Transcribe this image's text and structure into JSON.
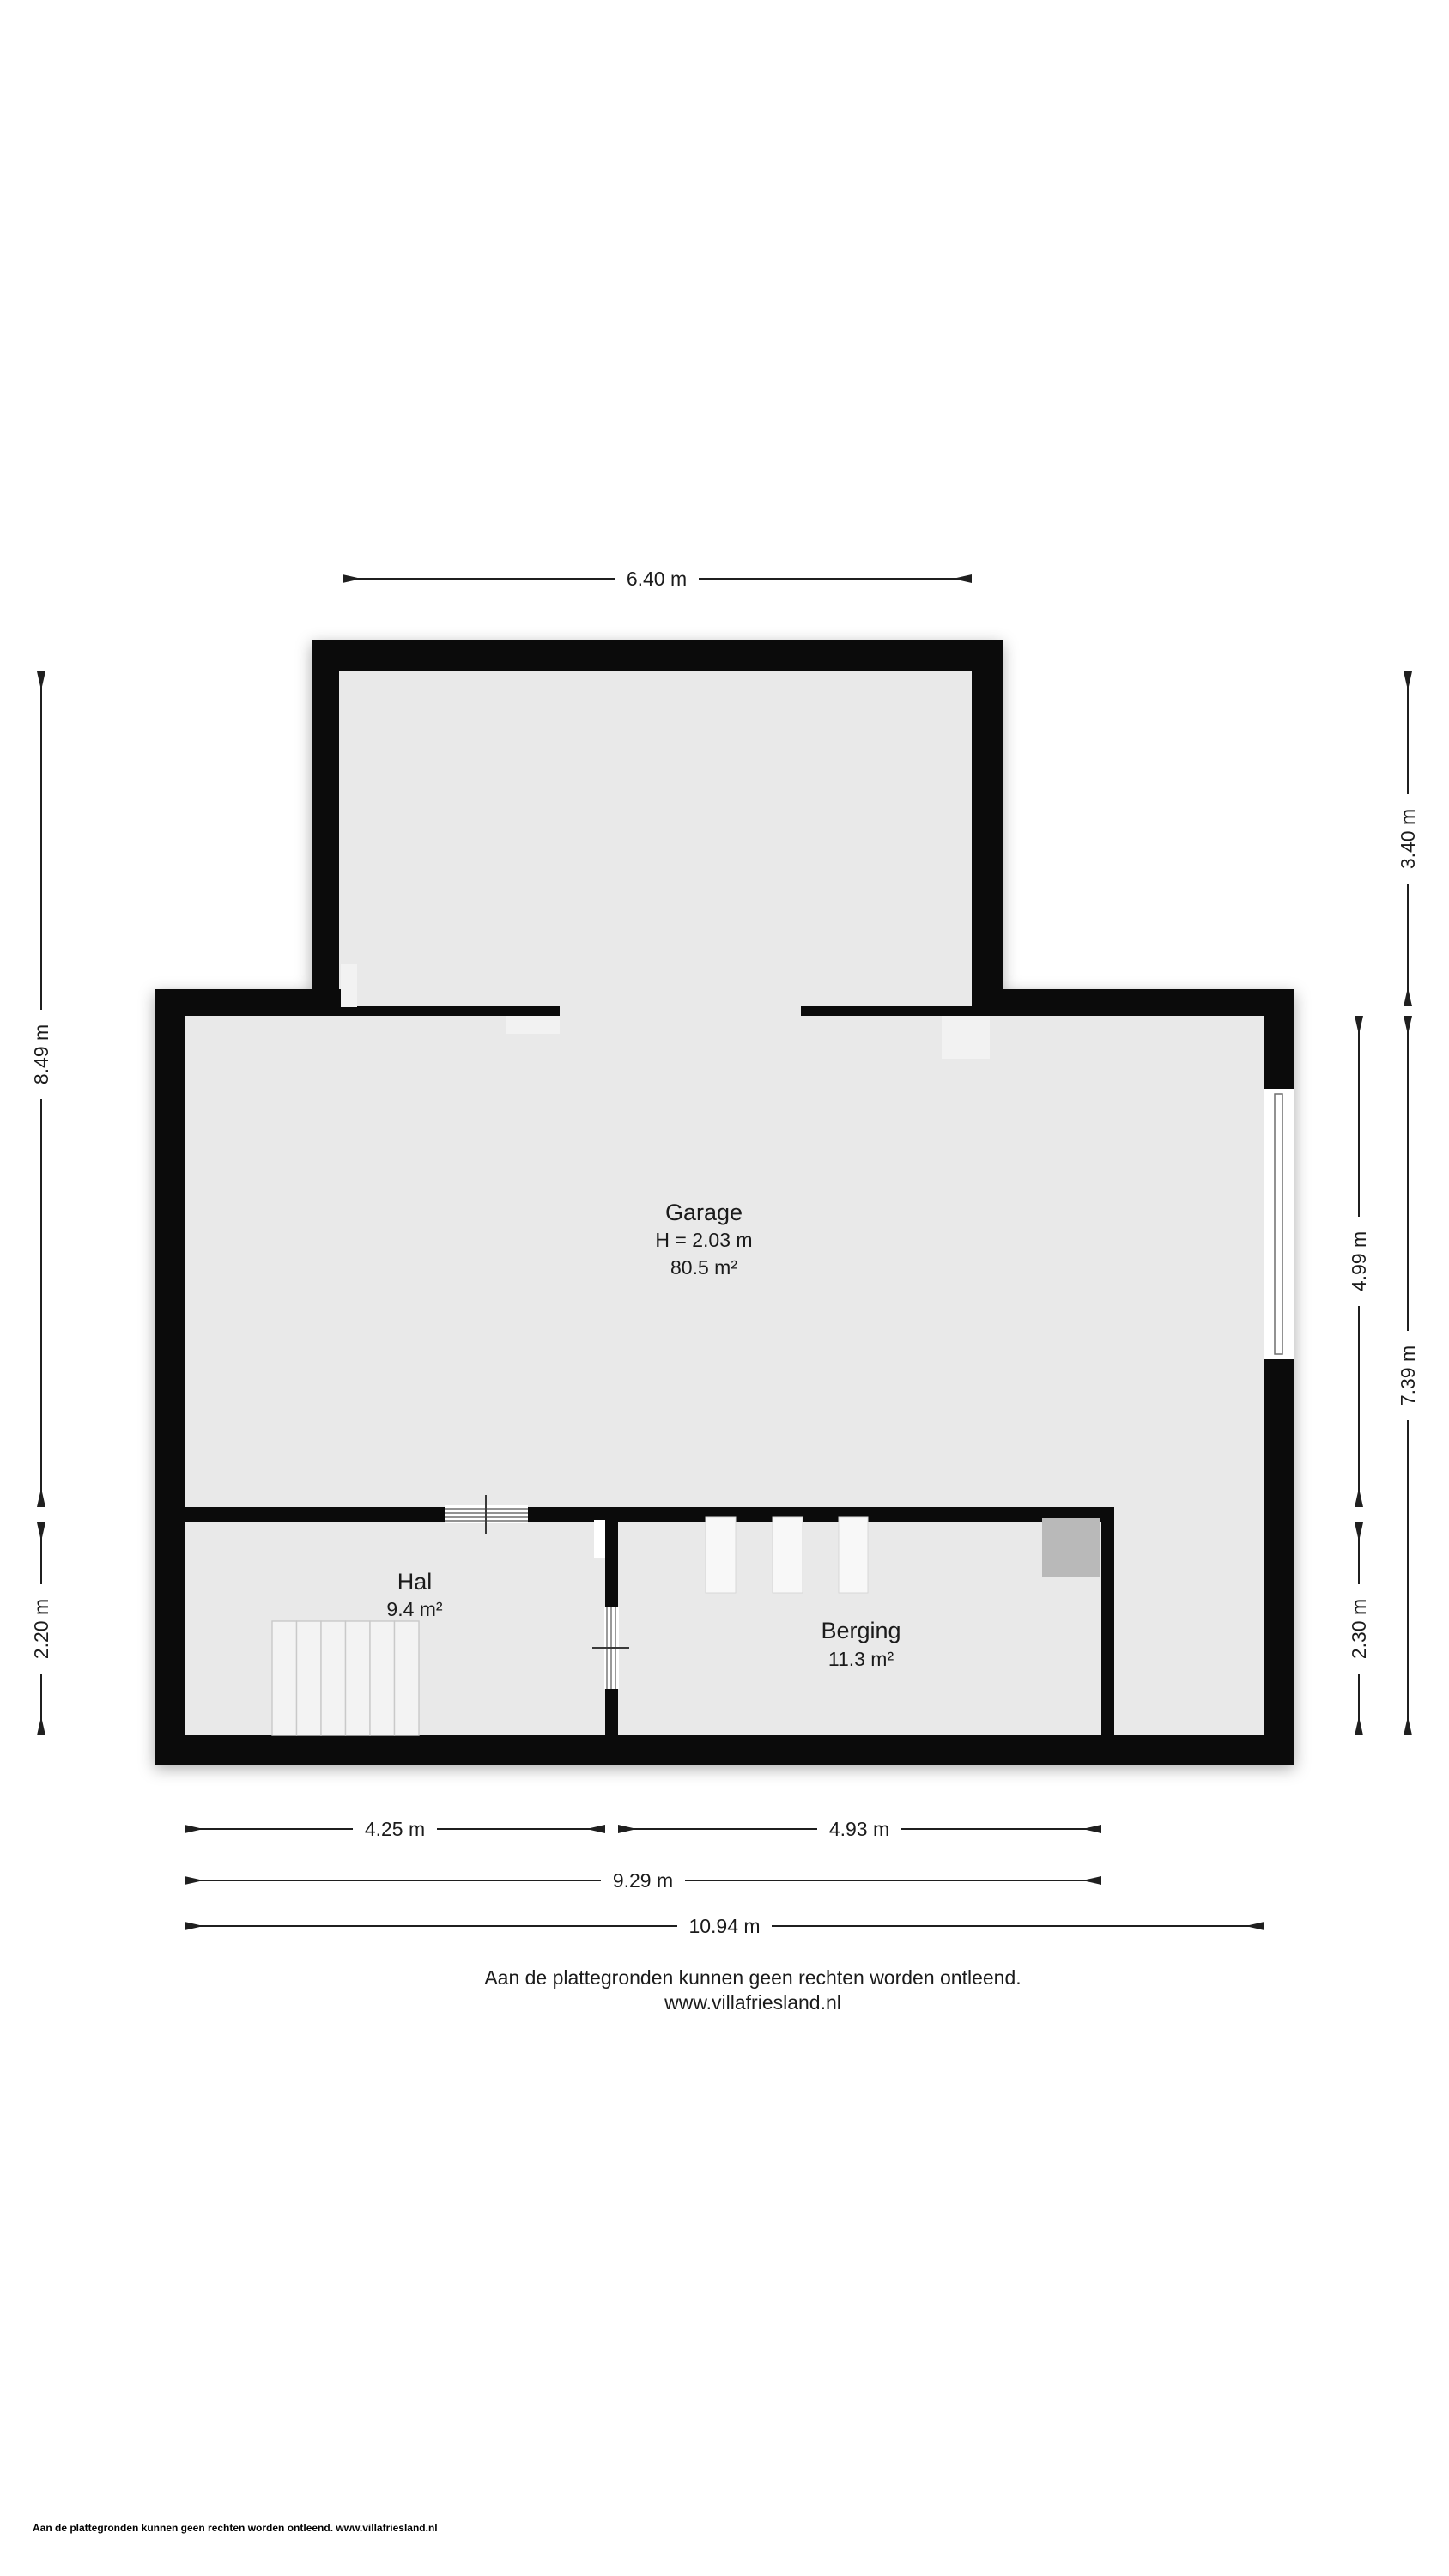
{
  "rooms": {
    "garage": {
      "name": "Garage",
      "height": "H = 2.03 m",
      "area": "80.5 m²"
    },
    "hal": {
      "name": "Hal",
      "area": "9.4 m²"
    },
    "berging": {
      "name": "Berging",
      "area": "11.3 m²"
    }
  },
  "dimensions": {
    "top_width": "6.40 m",
    "left_upper": "8.49 m",
    "left_lower": "2.20 m",
    "right_extension": "3.40 m",
    "right_garage": "4.99 m",
    "right_lower": "2.30 m",
    "right_total": "7.39 m",
    "bottom_hal": "4.25 m",
    "bottom_berging": "4.93 m",
    "bottom_inner": "9.29 m",
    "bottom_total": "10.94 m"
  },
  "footer": {
    "disclaimer": "Aan de plattegronden kunnen geen rechten worden ontleend.",
    "website": "www.villafriesland.nl",
    "small_print": "Aan de plattegronden kunnen geen rechten worden ontleend. www.villafriesland.nl"
  },
  "colors": {
    "wall": "#0b0b0b",
    "floor": "#e9e9e9",
    "stairs": "#f3f3f3",
    "fixture_gray": "#b9b9b9",
    "line": "#1f1f1f",
    "background": "#ffffff"
  }
}
